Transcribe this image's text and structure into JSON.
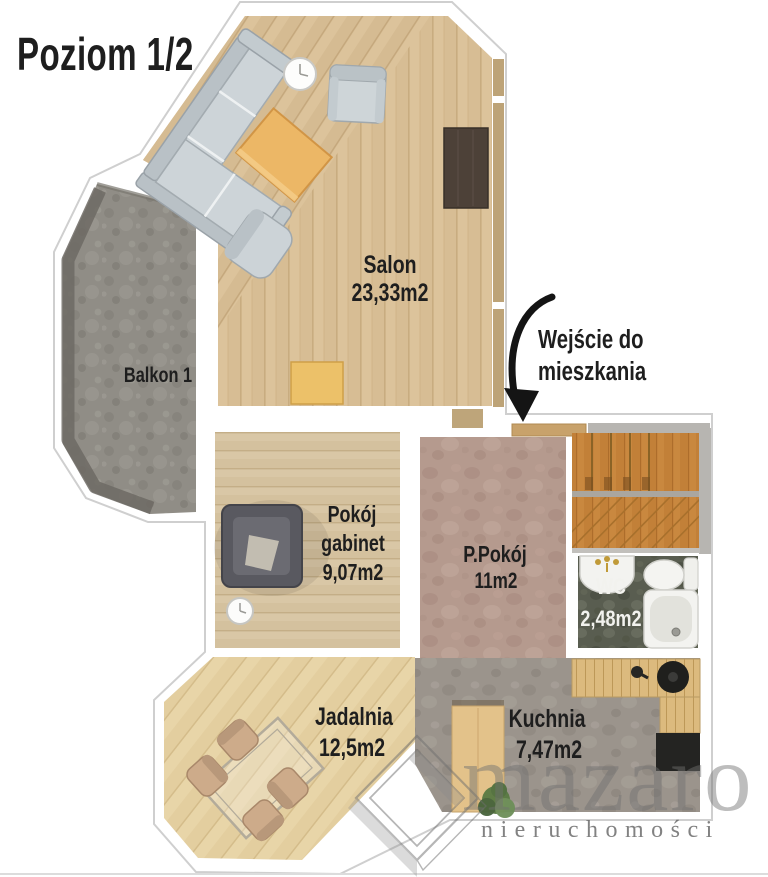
{
  "title": "Poziom 1/2",
  "entry_annotation": {
    "line1": "Wejście do",
    "line2": "mieszkania"
  },
  "rooms": {
    "salon": {
      "name": "Salon",
      "area": "23,33m2"
    },
    "balkon": {
      "name": "Balkon 1"
    },
    "gabinet": {
      "name_line1": "Pokój",
      "name_line2": "gabinet",
      "area": "9,07m2"
    },
    "ppokoj": {
      "name": "P.Pokój",
      "area": "11m2"
    },
    "wc": {
      "name": "WC",
      "area": "2,48m2"
    },
    "jadalnia": {
      "name": "Jadalnia",
      "area": "12,5m2"
    },
    "kuchnia": {
      "name": "Kuchnia",
      "area": "7,47m2"
    }
  },
  "watermark": {
    "brand": "mazaro",
    "subtitle": "nieruchomości"
  },
  "colors": {
    "wood_salon": "#dcc39b",
    "wood_jadalnia": "#e8d5a8",
    "wood_gabinet": "#d9c7a6",
    "stairs_wood": "#c9883f",
    "balcony_concrete": "#908d86",
    "hall_floor": "#b59a8e",
    "wc_floor": "#595d50",
    "kitchen_floor": "#9b948c",
    "sofa_grey": "#cdd4d8",
    "coffee_table_accent": "#ecb766",
    "annotation_black": "#141414",
    "watermark_grey": "#6f6f6f"
  }
}
